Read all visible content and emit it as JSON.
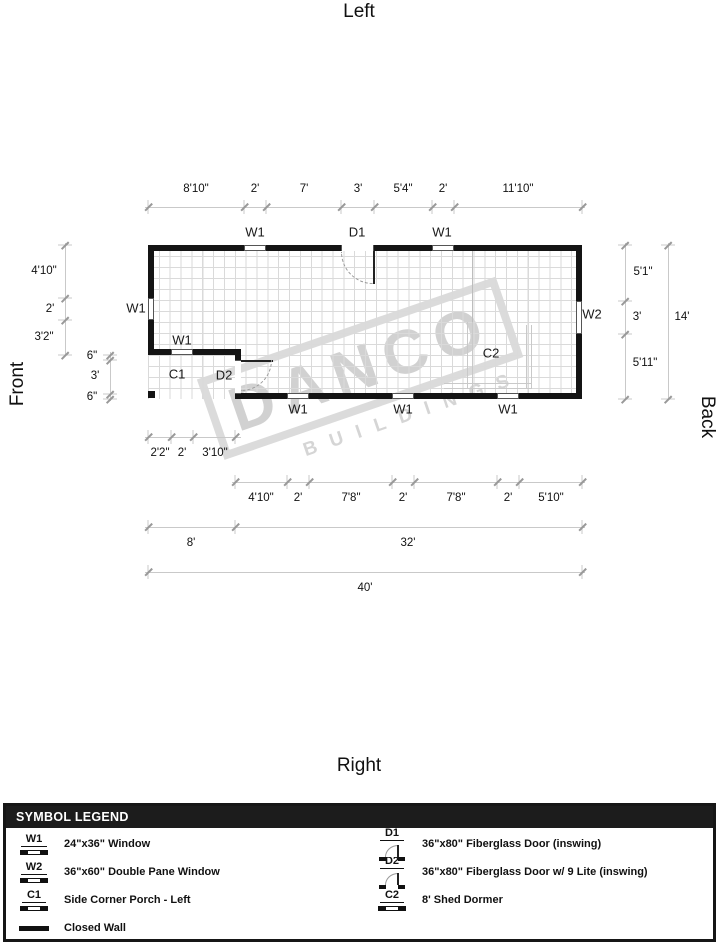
{
  "orientation": {
    "top": "Left",
    "bottom": "Right",
    "left": "Front",
    "right": "Back"
  },
  "watermark": {
    "name": "DANCO",
    "sub": "BUILDINGS"
  },
  "plan": {
    "markers": {
      "top_w1a": "W1",
      "top_d1": "D1",
      "top_w1b": "W1",
      "left_w1": "W1",
      "porch_w1": "W1",
      "c1": "C1",
      "d2": "D2",
      "c2": "C2",
      "w2": "W2",
      "bottom_w1a": "W1",
      "bottom_w1b": "W1",
      "bottom_w1c": "W1"
    },
    "dims": {
      "top": [
        "8'10\"",
        "2'",
        "7'",
        "3'",
        "5'4\"",
        "2'",
        "11'10\""
      ],
      "left_outer": [
        "4'10\"",
        "2'",
        "3'2\""
      ],
      "left_inner": [
        "6\"",
        "3'",
        "6\""
      ],
      "right_inner": [
        "5'1\"",
        "3'",
        "5'11\""
      ],
      "right_total": "14'",
      "porch_bottom": [
        "2'2\"",
        "2'",
        "3'10\""
      ],
      "bottom": [
        "4'10\"",
        "2'",
        "7'8\"",
        "2'",
        "7'8\"",
        "2'",
        "5'10\""
      ],
      "bottom_totals": [
        "8'",
        "32'"
      ],
      "overall": "40'"
    }
  },
  "legend": {
    "title": "SYMBOL LEGEND",
    "left": [
      {
        "code": "W1",
        "desc": "24\"x36\" Window"
      },
      {
        "code": "W2",
        "desc": "36\"x60\" Double Pane Window"
      },
      {
        "code": "C1",
        "desc": "Side Corner Porch - Left"
      },
      {
        "code": "",
        "desc": "Closed Wall"
      }
    ],
    "right": [
      {
        "code": "D1",
        "desc": "36\"x80\" Fiberglass Door (inswing)"
      },
      {
        "code": "D2",
        "desc": "36\"x80\" Fiberglass Door w/ 9 Lite (inswing)"
      },
      {
        "code": "C2",
        "desc": "8' Shed Dormer"
      }
    ]
  }
}
